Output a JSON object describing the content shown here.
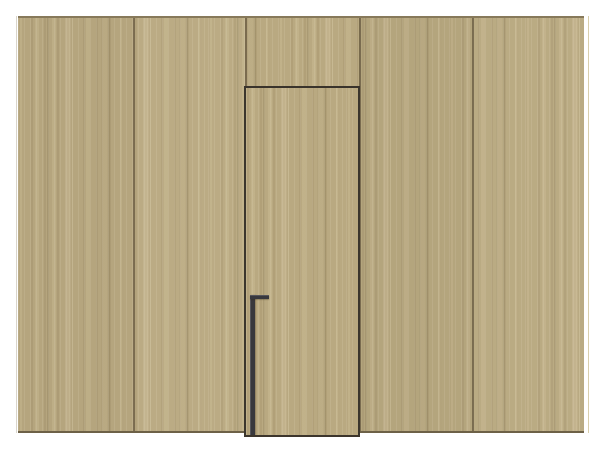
{
  "scene": {
    "kind": "interior-product-render",
    "description": "Light oak vertically grained wood panelled wall with a concealed flush door and a floor-to-lever black L-shaped pull handle; white floor and background margin",
    "canvas": {
      "width": 600,
      "height": 450
    },
    "wall": {
      "x": 18,
      "y": 16,
      "width": 566,
      "height": 417
    },
    "panels": [
      {
        "x": 18,
        "width": 115,
        "grain_offset": 0,
        "tint": "rgba(0,0,0,0.020)"
      },
      {
        "x": 133,
        "width": 112,
        "grain_offset": -37,
        "tint": "rgba(255,255,255,0.030)"
      },
      {
        "x": 245,
        "width": 114,
        "grain_offset": -81,
        "tint": "rgba(0,0,0,0.0)"
      },
      {
        "x": 359,
        "width": 113,
        "grain_offset": -23,
        "tint": "rgba(0,0,0,0.025)"
      },
      {
        "x": 472,
        "width": 112,
        "grain_offset": -59,
        "tint": "rgba(255,255,255,0.022)"
      }
    ],
    "seams_x": [
      133,
      245,
      359,
      472
    ],
    "door": {
      "x": 244,
      "y": 86,
      "width": 116,
      "height": 351,
      "grain_offset": -12
    },
    "handle": {
      "x": 250,
      "y": 295,
      "bar_width": 5,
      "bar_height": 140,
      "top_length": 19,
      "top_thickness": 4
    },
    "left_edge_line_x": 16,
    "right_edge_line_x": 588
  },
  "colors": {
    "bg": "#ffffff",
    "wood-base": "#b9a981",
    "wall-top-edge": "#87795a",
    "wall-bottom-edge": "#6d6147",
    "seam": "rgba(88,74,50,0.65)",
    "door-gap": "#3b362d",
    "door-top": "#39332b",
    "door-bottom": "#3c352c",
    "handle": "#38383d",
    "handle-highlight": "#55555a",
    "left-return": "rgba(185,178,160,0.55)",
    "right-return": "#d9cfac"
  }
}
